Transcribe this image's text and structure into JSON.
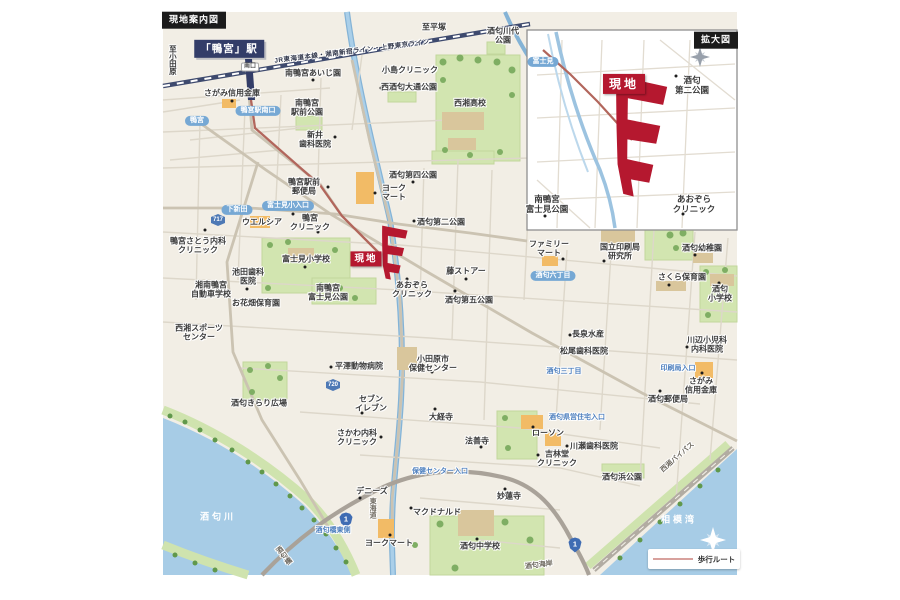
{
  "meta": {
    "map_title_box": "現地案内図",
    "inset_title_box": "拡大図"
  },
  "legend": {
    "walking_route": "歩行ルート"
  },
  "colors": {
    "accent_red": "#b5182f",
    "station_navy": "#333d68",
    "water_blue": "#a7cce6",
    "park_green": "#d2e5b0",
    "sign_blue": "#76a8d4",
    "route_line": "#b2665c",
    "legend_line": "#d8a19d",
    "map_cream": "#f2eee5"
  },
  "labels": [
    {
      "t": "現地案内図",
      "c": "corner",
      "x": 194,
      "y": 20
    },
    {
      "t": "「鴨宮」駅",
      "c": "station",
      "x": 229,
      "y": 49
    },
    {
      "t": "南口",
      "c": "minibox",
      "x": 250,
      "y": 67
    },
    {
      "t": "至小田原",
      "c": "dirv",
      "x": 172,
      "y": 60
    },
    {
      "t": "JR東海道本線・湘南新宿ライン・上野東京ライン",
      "c": "rail",
      "x": 352,
      "y": 52,
      "r": -7
    },
    {
      "t": "至平塚",
      "c": "dir",
      "x": 434,
      "y": 27
    },
    {
      "t": "さがみ信用金庫",
      "c": "f",
      "x": 232,
      "y": 93
    },
    {
      "t": "南鴨宮あいじ園",
      "c": "f",
      "x": 313,
      "y": 73
    },
    {
      "t": "小島クリニック",
      "c": "f",
      "x": 410,
      "y": 70
    },
    {
      "t": "西酒匂大通公園",
      "c": "f",
      "x": 409,
      "y": 87
    },
    {
      "t": "南鴨宮\n駅前公園",
      "c": "f",
      "x": 307,
      "y": 108
    },
    {
      "t": "新井\n歯科医院",
      "c": "f",
      "x": 315,
      "y": 140
    },
    {
      "t": "酒匂川代\n公園",
      "c": "f",
      "x": 503,
      "y": 36
    },
    {
      "t": "西湘高校",
      "c": "f",
      "x": 470,
      "y": 103
    },
    {
      "t": "酒匂第四公園",
      "c": "f",
      "x": 413,
      "y": 175
    },
    {
      "t": "鴨宮駅前\n郵便局",
      "c": "f",
      "x": 304,
      "y": 187
    },
    {
      "t": "ヨーク\nマート",
      "c": "f",
      "x": 394,
      "y": 193
    },
    {
      "t": "鴨宮駅南口",
      "c": "sign",
      "x": 258,
      "y": 111
    },
    {
      "t": "鴨宮",
      "c": "sign",
      "x": 197,
      "y": 121
    },
    {
      "t": "下新田",
      "c": "sign",
      "x": 237,
      "y": 210
    },
    {
      "t": "717",
      "c": "shield6",
      "x": 218,
      "y": 220
    },
    {
      "t": "富士見小入口",
      "c": "sign",
      "x": 288,
      "y": 206
    },
    {
      "t": "ウエルシア",
      "c": "f",
      "x": 262,
      "y": 222
    },
    {
      "t": "鴨宮\nクリニック",
      "c": "f",
      "x": 310,
      "y": 223
    },
    {
      "t": "鴨宮さとう内科\nクリニック",
      "c": "f",
      "x": 198,
      "y": 246
    },
    {
      "t": "酒匂第二公園",
      "c": "f",
      "x": 441,
      "y": 222
    },
    {
      "t": "現地",
      "c": "genchi",
      "x": 366,
      "y": 259
    },
    {
      "t": "富士見小学校",
      "c": "f",
      "x": 306,
      "y": 259
    },
    {
      "t": "池田歯科\n医院",
      "c": "f",
      "x": 248,
      "y": 277
    },
    {
      "t": "湘南鴨宮\n自動車学校",
      "c": "f",
      "x": 211,
      "y": 290
    },
    {
      "t": "お花畑保育園",
      "c": "f",
      "x": 256,
      "y": 303
    },
    {
      "t": "南鴨宮\n富士見公園",
      "c": "f",
      "x": 328,
      "y": 293
    },
    {
      "t": "あおぞら\nクリニック",
      "c": "f",
      "x": 412,
      "y": 290
    },
    {
      "t": "藤ストアー",
      "c": "f",
      "x": 466,
      "y": 271
    },
    {
      "t": "酒匂第五公園",
      "c": "f",
      "x": 469,
      "y": 300
    },
    {
      "t": "ファミリー\nマート",
      "c": "f",
      "x": 549,
      "y": 249
    },
    {
      "t": "国立印刷局\n研究所",
      "c": "f",
      "x": 620,
      "y": 252
    },
    {
      "t": "酒匂幼稚園",
      "c": "f",
      "x": 702,
      "y": 248
    },
    {
      "t": "さくら保育園",
      "c": "f",
      "x": 682,
      "y": 277
    },
    {
      "t": "酒匂\n小学校",
      "c": "f",
      "x": 720,
      "y": 294
    },
    {
      "t": "長泉水産",
      "c": "f",
      "x": 588,
      "y": 334
    },
    {
      "t": "松尾歯科医院",
      "c": "f",
      "x": 584,
      "y": 351
    },
    {
      "t": "川辺小児科\n内科医院",
      "c": "f",
      "x": 707,
      "y": 345
    },
    {
      "t": "酒匂三丁目",
      "c": "bsign",
      "x": 564,
      "y": 372
    },
    {
      "t": "印刷局入口",
      "c": "bsign",
      "x": 678,
      "y": 369
    },
    {
      "t": "さがみ\n信用金庫",
      "c": "f",
      "x": 701,
      "y": 386
    },
    {
      "t": "酒匂郵便局",
      "c": "f",
      "x": 668,
      "y": 399
    },
    {
      "t": "酒匂六丁目",
      "c": "sign",
      "x": 553,
      "y": 276
    },
    {
      "t": "西湘スポーツ\nセンター",
      "c": "f",
      "x": 199,
      "y": 333
    },
    {
      "t": "酒匂きらり広場",
      "c": "f",
      "x": 259,
      "y": 403
    },
    {
      "t": "平澤動物病院",
      "c": "f",
      "x": 359,
      "y": 366
    },
    {
      "t": "小田原市\n保健センター",
      "c": "f",
      "x": 433,
      "y": 364
    },
    {
      "t": "セブン\nイレブン",
      "c": "f",
      "x": 371,
      "y": 404
    },
    {
      "t": "720",
      "c": "shield6",
      "x": 333,
      "y": 385
    },
    {
      "t": "大経寺",
      "c": "f",
      "x": 441,
      "y": 417
    },
    {
      "t": "さかわ内科\nクリニック",
      "c": "f",
      "x": 357,
      "y": 438
    },
    {
      "t": "法善寺",
      "c": "f",
      "x": 477,
      "y": 441
    },
    {
      "t": "ローソン",
      "c": "f",
      "x": 548,
      "y": 433
    },
    {
      "t": "酒匂県営住宅入口",
      "c": "bsign",
      "x": 577,
      "y": 418
    },
    {
      "t": "川瀬歯科医院",
      "c": "f",
      "x": 594,
      "y": 446
    },
    {
      "t": "吉林堂\nクリニック",
      "c": "f",
      "x": 557,
      "y": 459
    },
    {
      "t": "保健センター入口",
      "c": "bsign",
      "x": 440,
      "y": 472
    },
    {
      "t": "妙蓮寺",
      "c": "f",
      "x": 509,
      "y": 496
    },
    {
      "t": "デニーズ",
      "c": "f",
      "x": 372,
      "y": 491
    },
    {
      "t": "東海道",
      "c": "roadv",
      "x": 372,
      "y": 508
    },
    {
      "t": "マクドナルド",
      "c": "f",
      "x": 437,
      "y": 512
    },
    {
      "t": "1",
      "c": "shield1",
      "x": 346,
      "y": 520
    },
    {
      "t": "酒匂橋東側",
      "c": "bsign",
      "x": 333,
      "y": 531
    },
    {
      "t": "酒匂橋",
      "c": "roadv",
      "x": 283,
      "y": 556,
      "r": -38
    },
    {
      "t": "酒匂川",
      "c": "waterl",
      "x": 218,
      "y": 517
    },
    {
      "t": "ヨークマート",
      "c": "f",
      "x": 389,
      "y": 543
    },
    {
      "t": "酒匂中学校",
      "c": "f",
      "x": 480,
      "y": 546
    },
    {
      "t": "1",
      "c": "shield1",
      "x": 575,
      "y": 545
    },
    {
      "t": "酒匂海岸",
      "c": "roadd",
      "x": 539,
      "y": 566,
      "r": -7
    },
    {
      "t": "酒匂浜公園",
      "c": "f",
      "x": 622,
      "y": 477
    },
    {
      "t": "西湘バイパス",
      "c": "roadd",
      "x": 678,
      "y": 458,
      "r": -41
    },
    {
      "t": "相模湾",
      "c": "waterl",
      "x": 679,
      "y": 520
    },
    {
      "t": "拡大図",
      "c": "corner",
      "x": 716,
      "y": 40
    },
    {
      "t": "富士見",
      "c": "sign",
      "x": 543,
      "y": 62
    },
    {
      "t": "現地",
      "c": "genchib",
      "x": 624,
      "y": 84
    },
    {
      "t": "酒匂\n第二公園",
      "c": "f2",
      "x": 692,
      "y": 85
    },
    {
      "t": "南鴨宮\n富士見公園",
      "c": "f2",
      "x": 547,
      "y": 204
    },
    {
      "t": "あおぞら\nクリニック",
      "c": "f2",
      "x": 694,
      "y": 204
    }
  ],
  "dots": [
    [
      232,
      101
    ],
    [
      383,
      71
    ],
    [
      381,
      88
    ],
    [
      313,
      80
    ],
    [
      335,
      137
    ],
    [
      413,
      182
    ],
    [
      375,
      193
    ],
    [
      293,
      214
    ],
    [
      318,
      232
    ],
    [
      328,
      187
    ],
    [
      205,
      230
    ],
    [
      247,
      289
    ],
    [
      305,
      267
    ],
    [
      414,
      221
    ],
    [
      407,
      279
    ],
    [
      455,
      291
    ],
    [
      466,
      279
    ],
    [
      563,
      259
    ],
    [
      604,
      261
    ],
    [
      695,
      255
    ],
    [
      669,
      285
    ],
    [
      719,
      283
    ],
    [
      570,
      335
    ],
    [
      561,
      351
    ],
    [
      687,
      347
    ],
    [
      702,
      373
    ],
    [
      660,
      391
    ],
    [
      432,
      372
    ],
    [
      331,
      367
    ],
    [
      362,
      413
    ],
    [
      381,
      437
    ],
    [
      435,
      409
    ],
    [
      481,
      447
    ],
    [
      533,
      427
    ],
    [
      538,
      455
    ],
    [
      567,
      446
    ],
    [
      505,
      489
    ],
    [
      360,
      498
    ],
    [
      411,
      508
    ],
    [
      477,
      539
    ],
    [
      390,
      535
    ],
    [
      676,
      76
    ],
    [
      683,
      214
    ],
    [
      545,
      216
    ]
  ]
}
